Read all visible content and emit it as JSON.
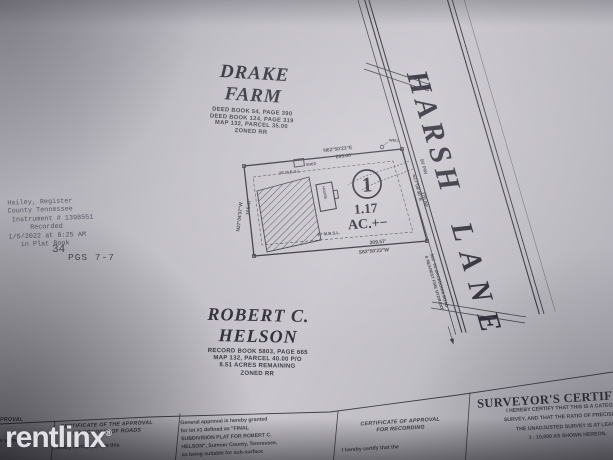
{
  "watermark": {
    "brand": "rentlinx",
    "registered": "®"
  },
  "drake_farm": {
    "title": "DRAKE FARM",
    "deed1": "DEED BOOK 54, PAGE 390",
    "deed2": "DEED BOOK 124, PAGE 319",
    "map": "MAP 132, PARCEL 35.00",
    "zoning": "ZONED RR"
  },
  "harsh_lane": {
    "word1": "HARSH",
    "word2": "LANE",
    "right_of_way": "50' P/W",
    "note_line1": "800' TO MACEDONIA ROAD",
    "note_line2": "& NEAREST FIRE HYDRANT"
  },
  "lot1": {
    "number": "1",
    "area": "1.17",
    "area_suffix": "AC.+−",
    "north_bearing": "N62°50'23\"E",
    "north_distance": "295.00'",
    "south_distance": "309.57'",
    "south_bearing": "S62°50'23\"W",
    "west_bearing": "N27°04'37\"W",
    "west_distance": "165.47'",
    "east_bearing": "S27°09'40\"E",
    "east_distance": "170.00'",
    "setback_rear": "20' M.B.S.L.",
    "setback_front": "40' M.B.S.L.",
    "shed_label": "SHED",
    "house_label": "HOUSE",
    "well_label": "WELL"
  },
  "recording_stamp": {
    "line1": "Hailey, Register",
    "line2": "County Tennessee",
    "line3": "Instrument # 1398551",
    "line4": "Recorded",
    "line5": "1/5/2022 at 8:25 AM",
    "line6": "in Plat Book",
    "book_number": "34",
    "pages": "PGS 7-7"
  },
  "helson": {
    "title": "ROBERT C. HELSON",
    "record": "RECORD BOOK 5803, PAGE 665",
    "map": "MAP 132, PARCEL 40.00 P/O",
    "acres": "8.51 ACRES REMAINING",
    "zoning": "ZONED RR"
  },
  "certificates": {
    "water": {
      "header_fragment": "PROVAL",
      "body_fragment": "e water"
    },
    "roads": {
      "header_line1": "CERTIFICATE OF THE APPROVAL",
      "header_line2": "OR BONDING OF ROADS",
      "body": "I hereby certify: (1) that this"
    },
    "soils": {
      "line1": "General approval is hereby granted",
      "line2": "for lot #1 defined as \"FINAL",
      "line3": "SUBDIVISION PLAT FOR ROBERT C.",
      "line4": "HELSON\", Sumner County, Tennessee,",
      "line5": "as being suitable for sub-surface"
    },
    "recording": {
      "header_line1": "CERTIFICATE OF APPROVAL",
      "header_line2": "FOR RECORDING",
      "body": "I hereby certify that the"
    },
    "surveyor": {
      "title": "SURVEYOR'S CERTIFICATE",
      "line1": "I HEREBY CERTIFY THAT THIS IS A CATEGORY I",
      "line2": "SURVEY, AND THAT THE RATIO OF PRECISION OF",
      "line3": "THE UNADJUSTED SURVEY IS AT LEAST",
      "line4": "1 : 10,000 AS SHOWN HEREON."
    }
  }
}
